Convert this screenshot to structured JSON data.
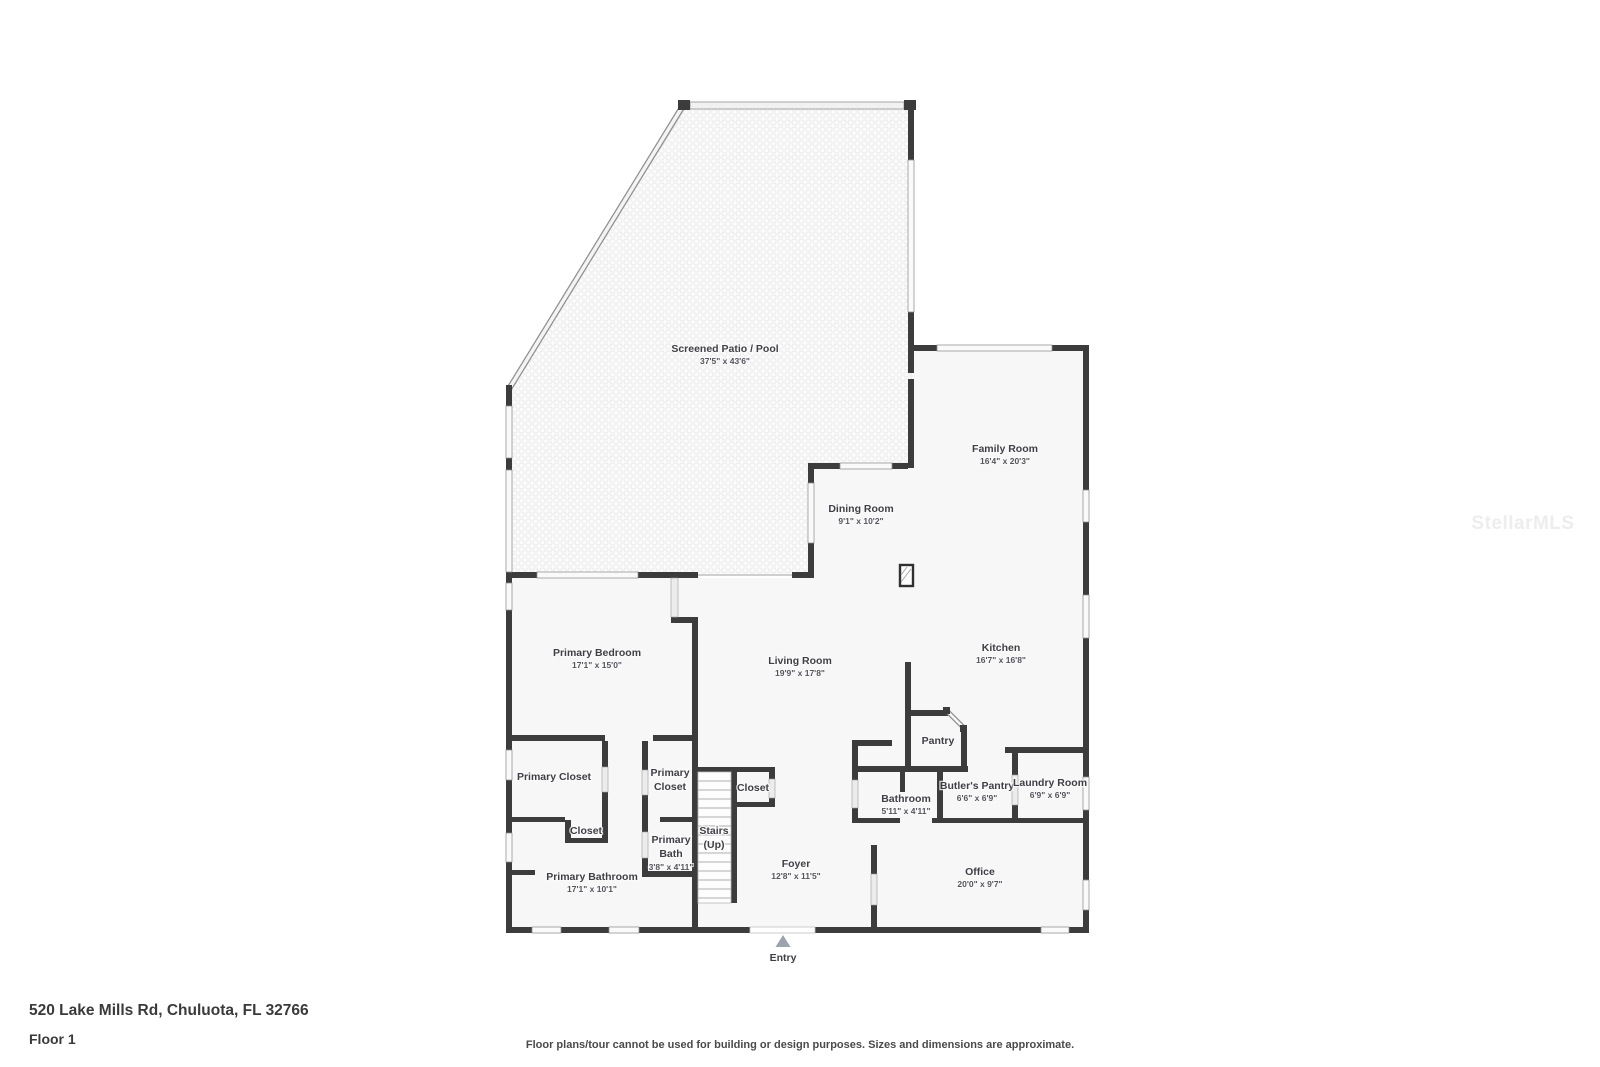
{
  "footer": {
    "address": "520 Lake Mills Rd, Chuluota, FL 32766",
    "floor_label": "Floor 1",
    "disclaimer": "Floor plans/tour cannot be used for building or design purposes. Sizes and dimensions are approximate."
  },
  "watermark": {
    "text": "StellarMLS"
  },
  "colors": {
    "wall": "#3c3c3c",
    "floor": "#f7f7f7",
    "window_fill": "#fafafa",
    "label_text": "#3f3f46",
    "entry_marker": "#9ca3af"
  },
  "rooms": {
    "screened_patio": {
      "label": "Screened Patio / Pool",
      "dims": "37'5\" x 43'6\""
    },
    "family_room": {
      "label": "Family Room",
      "dims": "16'4\" x 20'3\""
    },
    "dining_room": {
      "label": "Dining Room",
      "dims": "9'1\" x 10'2\""
    },
    "primary_bedroom": {
      "label": "Primary Bedroom",
      "dims": "17'1\" x 15'0\""
    },
    "living_room": {
      "label": "Living Room",
      "dims": "19'9\" x 17'8\""
    },
    "kitchen": {
      "label": "Kitchen",
      "dims": "16'7\" x 16'8\""
    },
    "pantry": {
      "label": "Pantry"
    },
    "primary_closet": {
      "label": "Primary Closet"
    },
    "primary_closet_2": {
      "line1": "Primary",
      "line2": "Closet"
    },
    "closet_nook": {
      "label": "Closet"
    },
    "closet_hall": {
      "label": "Closet"
    },
    "primary_bath": {
      "line1": "Primary",
      "line2": "Bath",
      "dims": "3'8\" x 4'11\""
    },
    "stairs": {
      "line1": "Stairs",
      "line2": "(Up)"
    },
    "primary_bathroom": {
      "label": "Primary Bathroom",
      "dims": "17'1\" x 10'1\""
    },
    "foyer": {
      "label": "Foyer",
      "dims": "12'8\" x 11'5\""
    },
    "bathroom": {
      "label": "Bathroom",
      "dims": "5'11\" x 4'11\""
    },
    "butlers_pantry": {
      "label": "Butler's Pantry",
      "dims": "6'6\" x 6'9\""
    },
    "laundry_room": {
      "label": "Laundry Room",
      "dims": "6'9\" x 6'9\""
    },
    "office": {
      "label": "Office",
      "dims": "20'0\" x 9'7\""
    },
    "entry": {
      "label": "Entry"
    }
  }
}
